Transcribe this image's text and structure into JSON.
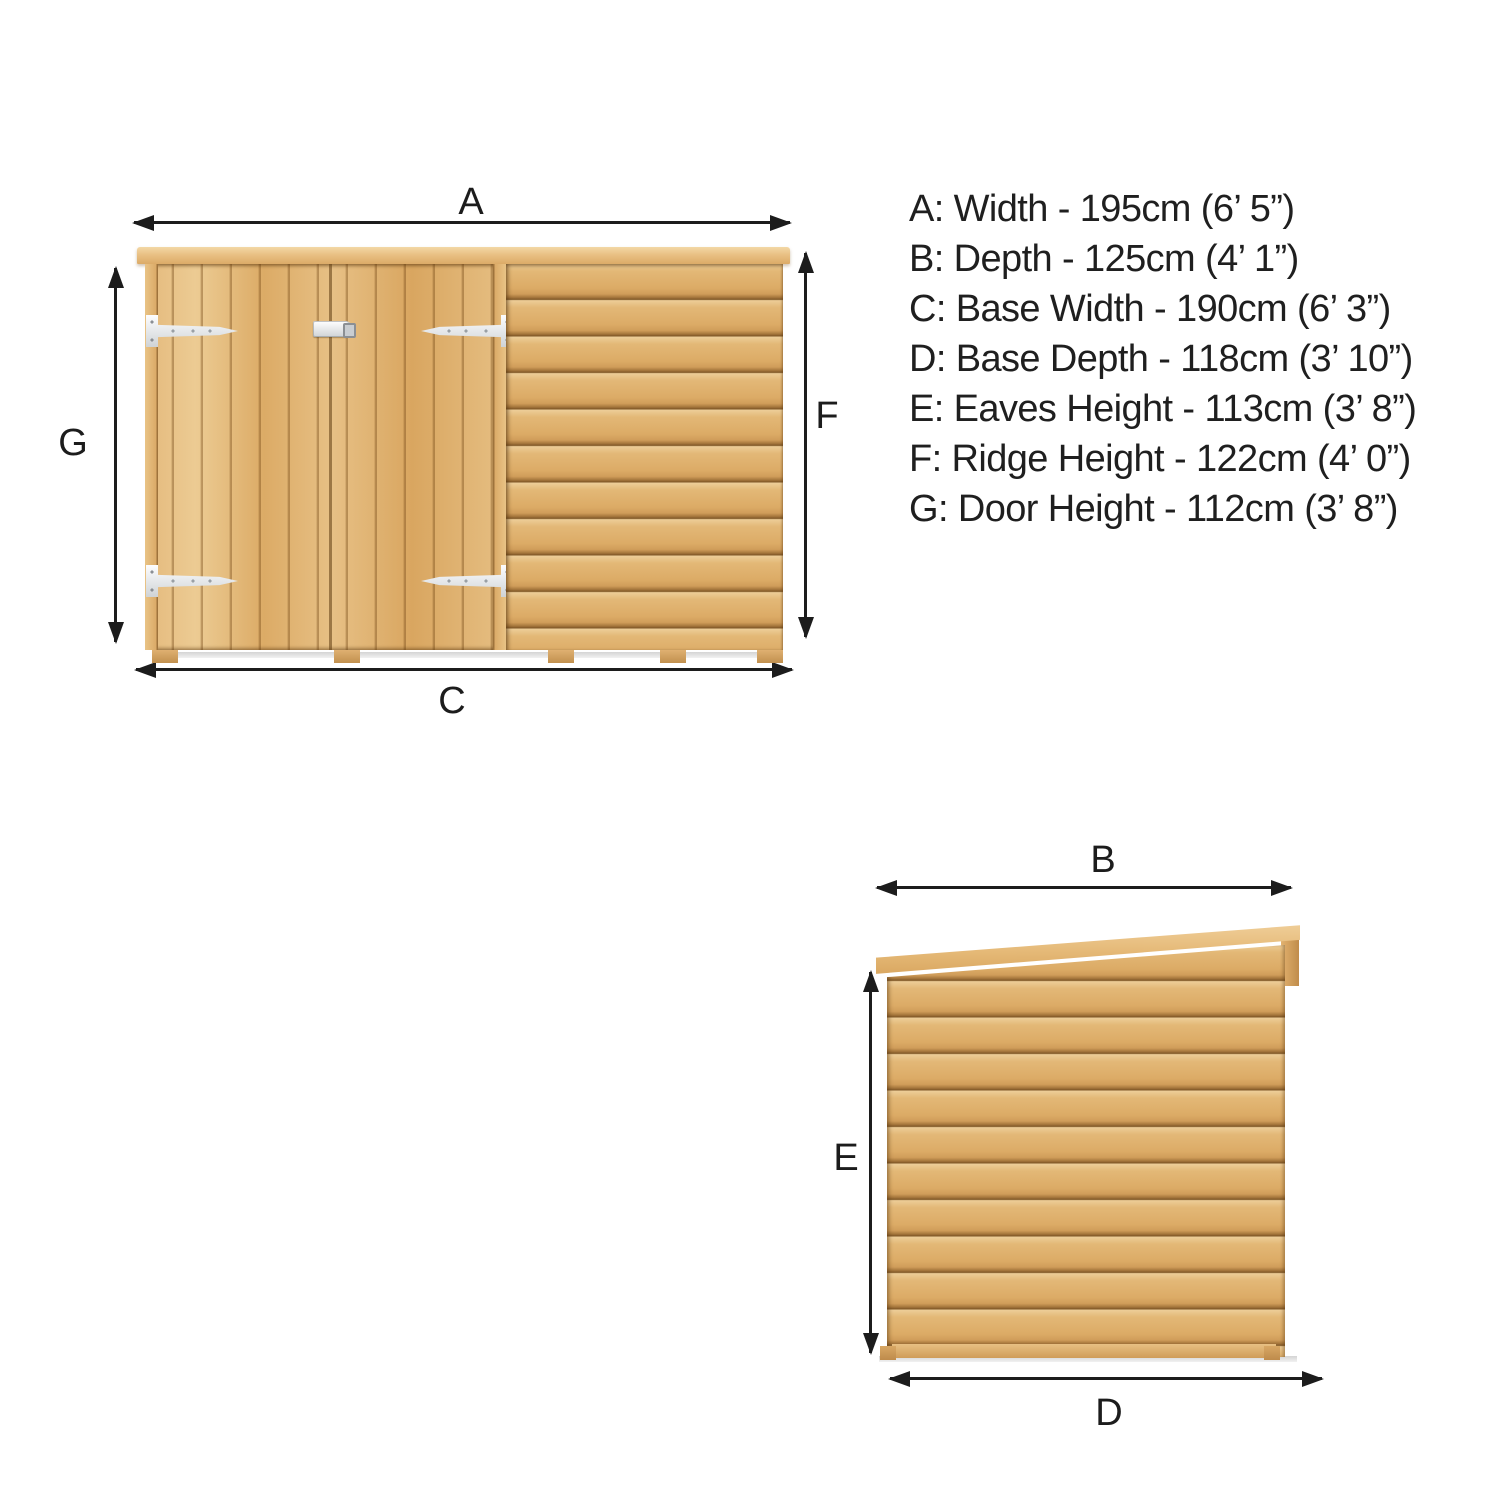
{
  "dimension_list": {
    "items": [
      {
        "letter": "A",
        "name": "Width",
        "metric": "195cm",
        "imperial": "6’ 5”",
        "text": "A: Width - 195cm (6’ 5”)"
      },
      {
        "letter": "B",
        "name": "Depth",
        "metric": "125cm",
        "imperial": "4’ 1”",
        "text": "B: Depth - 125cm (4’ 1”)"
      },
      {
        "letter": "C",
        "name": "Base Width",
        "metric": "190cm",
        "imperial": "6’ 3”",
        "text": "C: Base Width - 190cm (6’ 3”)"
      },
      {
        "letter": "D",
        "name": "Base Depth",
        "metric": "118cm",
        "imperial": "3’ 10”",
        "text": "D: Base Depth - 118cm (3’ 10”)"
      },
      {
        "letter": "E",
        "name": "Eaves Height",
        "metric": "113cm",
        "imperial": "3’ 8”",
        "text": "E: Eaves Height - 113cm (3’ 8”)"
      },
      {
        "letter": "F",
        "name": "Ridge Height",
        "metric": "122cm",
        "imperial": "4’ 0”",
        "text": "F: Ridge Height - 122cm (4’ 0”)"
      },
      {
        "letter": "G",
        "name": "Door Height",
        "metric": "112cm",
        "imperial": "3’ 8”",
        "text": "G: Door Height - 112cm (3’ 8”)"
      }
    ]
  },
  "front_view": {
    "top_label": "A",
    "left_label": "G",
    "right_label": "F",
    "bottom_label": "C"
  },
  "side_view": {
    "top_label": "B",
    "left_label": "E",
    "bottom_label": "D"
  },
  "colors": {
    "ink": "#1c1c1c",
    "wood_light": "#ecd09c",
    "wood_mid": "#dfb273",
    "wood_dark": "#c9955a",
    "wood_seam": "#7f5727",
    "hinge_metal": "#e8eaec",
    "shadow_grey": "#d4d4d4"
  }
}
